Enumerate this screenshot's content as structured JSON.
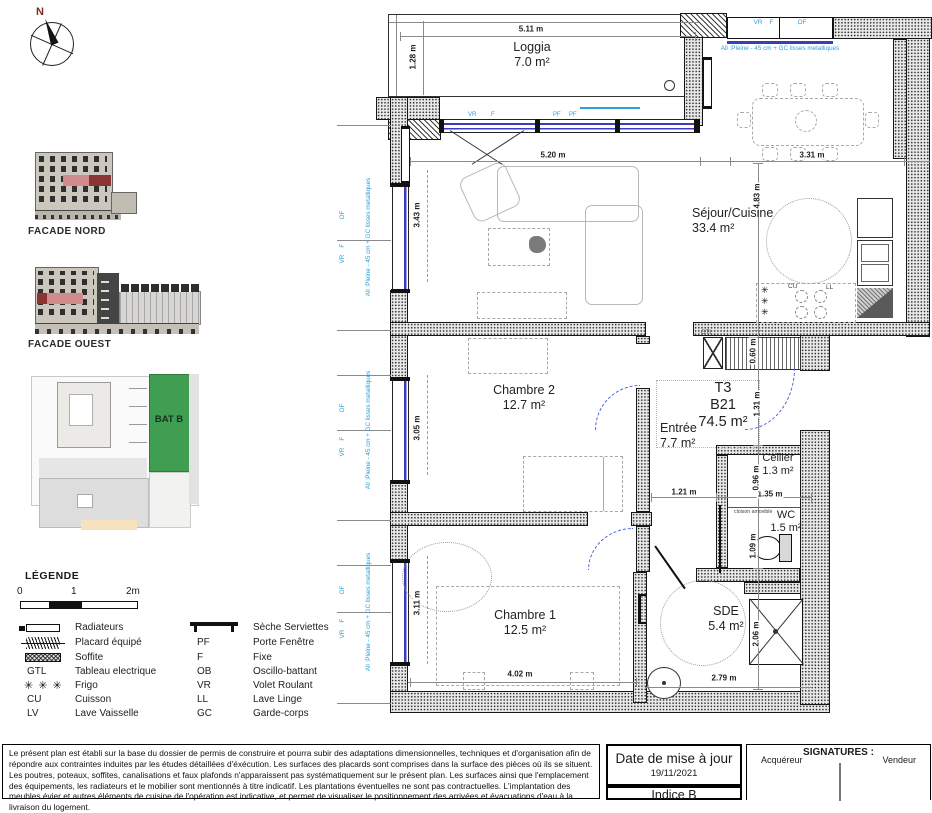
{
  "compass": {
    "n": "N"
  },
  "facades": {
    "nord": "FACADE NORD",
    "ouest": "FACADE OUEST"
  },
  "site": {
    "bat": "BAT B",
    "green": "#3f9e52",
    "facade_red": "#c75f5f"
  },
  "legend": {
    "title": "LÉGENDE",
    "scale_ticks": [
      "0",
      "1",
      "2m"
    ],
    "left": [
      {
        "abbr": "",
        "label": "Radiateurs"
      },
      {
        "abbr": "",
        "label": "Placard équipé"
      },
      {
        "abbr": "",
        "label": "Soffite"
      },
      {
        "abbr": "GTL",
        "label": "Tableau electrique"
      },
      {
        "abbr": "",
        "label": "Frigo"
      },
      {
        "abbr": "CU",
        "label": "Cuisson"
      },
      {
        "abbr": "LV",
        "label": "Lave Vaisselle"
      }
    ],
    "right": [
      {
        "abbr": "",
        "label": "Sèche Serviettes"
      },
      {
        "abbr": "PF",
        "label": "Porte Fenêtre"
      },
      {
        "abbr": "F",
        "label": "Fixe"
      },
      {
        "abbr": "OB",
        "label": "Oscillo-battant"
      },
      {
        "abbr": "VR",
        "label": "Volet Roulant"
      },
      {
        "abbr": "LL",
        "label": "Lave Linge"
      },
      {
        "abbr": "GC",
        "label": "Garde-corps"
      }
    ],
    "frigo_icon": "✳ ✳ ✳"
  },
  "unit": {
    "type": "T3",
    "code": "B21",
    "area": "74.5 m²"
  },
  "rooms": {
    "loggia": {
      "name": "Loggia",
      "area": "7.0 m²"
    },
    "sejour": {
      "name": "Séjour/Cuisine",
      "area": "33.4 m²"
    },
    "ch2": {
      "name": "Chambre 2",
      "area": "12.7 m²"
    },
    "ch1": {
      "name": "Chambre 1",
      "area": "12.5 m²"
    },
    "entree": {
      "name": "Entrée",
      "area": "7.7 m²"
    },
    "cellier": {
      "name": "Cellier",
      "area": "1.3 m²"
    },
    "wc": {
      "name": "WC",
      "area": "1.5 m²"
    },
    "sde": {
      "name": "SDE",
      "area": "5.4 m²"
    }
  },
  "dims": {
    "loggia_w": "5.11 m",
    "loggia_d": "1.28 m",
    "sejour_w": "5.20 m",
    "sejour_h": "3.43 m",
    "dining_w": "3.31 m",
    "dining_h": "4.83 m",
    "ch2_h": "3.05 m",
    "ch1_h": "3.11 m",
    "ch1_w": "4.02 m",
    "entree_w": "1.21 m",
    "entree_h": "1.31 m",
    "cellier_w": "1.35 m",
    "cellier_h": "0.96 m",
    "placard_d": "0.60 m",
    "wc_h": "1.09 m",
    "sde_w": "2.79 m",
    "sde_h": "2.06 m"
  },
  "notes": {
    "win1": "VR    F              OF",
    "win2": "All :Pleine - 45 cm + GC lisses metalliques",
    "vr": "VR",
    "f": "F",
    "pf": "PF",
    "gtl": "GTL",
    "cu": "CU",
    "ll": "LL",
    "frigo_star": "✳",
    "cloison": "cloison amovible",
    "blue": "#2ba0d8",
    "window_blue": "#3c3cc0",
    "door_blue": "#4a63d8"
  },
  "footer": {
    "disclaimer": "Le présent plan est établi sur la base du dossier de permis de construire et pourra subir des adaptations dimensionnelles, techniques et d'organisation afin de répondre aux contraintes induites par les études détaillées d'éxécution. Les surfaces des placards sont comprises dans la surface des pièces où ils se situent. Les poutres, poteaux, soffites, canalisations et faux plafonds n'apparaissent pas systématiquement sur le présent plan. Les surfaces ainsi que l'emplacement des équipements, les radiateurs et le mobilier sont mentionnés à titre indicatif. Les plantations éventuelles ne sont pas contractuelles. L'implantation des meubles évier et autres éléments de cuisine de l'opération est indicative, et permet de visualiser le positionnement des arrivées et évacuations d'eau à la livraison du logement.",
    "date_title": "Date de mise à jour",
    "date_value": "19/11/2021",
    "indice": "Indice B",
    "signatures_title": "SIGNATURES :",
    "acquereur": "Acquéreur",
    "vendeur": "Vendeur"
  }
}
